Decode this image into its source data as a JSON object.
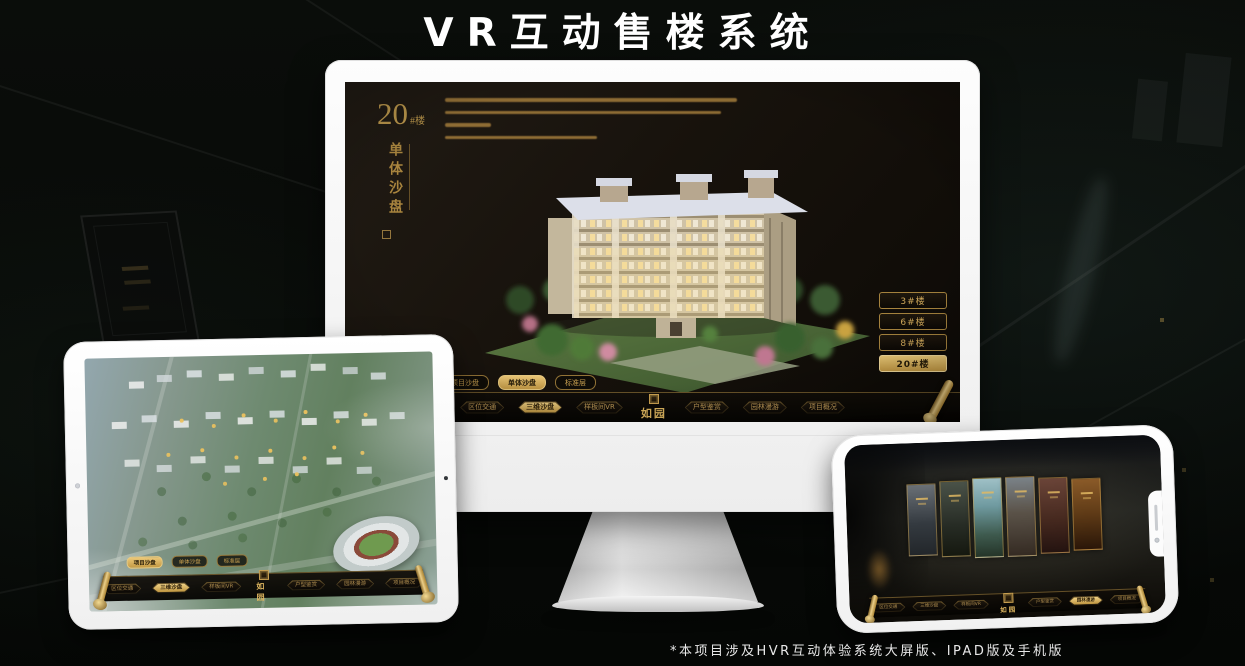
{
  "page": {
    "title": "VR互动售楼系统",
    "footnote": "*本项目涉及HVR互动体验系统大屏版、IPAD版及手机版"
  },
  "brand": {
    "logo": "如园"
  },
  "nav": {
    "items": [
      "区位交通",
      "三维沙盘",
      "样板间VR",
      "户型鉴赏",
      "园林漫游",
      "项目概况"
    ]
  },
  "view_tabs": [
    "项目沙盘",
    "单体沙盘",
    "标准层"
  ],
  "monitor_screen": {
    "building_number": "20",
    "building_number_suffix": "#楼",
    "vertical_title": "单体沙盘",
    "floor_buttons": [
      "3#楼",
      "6#楼",
      "8#楼",
      "20#楼"
    ],
    "active_floor": "20#楼",
    "active_tab": "单体沙盘",
    "active_nav": "三维沙盘"
  },
  "tablet_screen": {
    "active_tab": "项目沙盘",
    "active_nav": "三维沙盘"
  },
  "phone_screen": {
    "active_nav": "园林漫游",
    "gallery_panel_count": 6
  },
  "colors": {
    "gold": "#C9A050",
    "gold_bright": "#E8C878",
    "screen_bg": "#16120D",
    "nav_bg": "#0B0906"
  }
}
